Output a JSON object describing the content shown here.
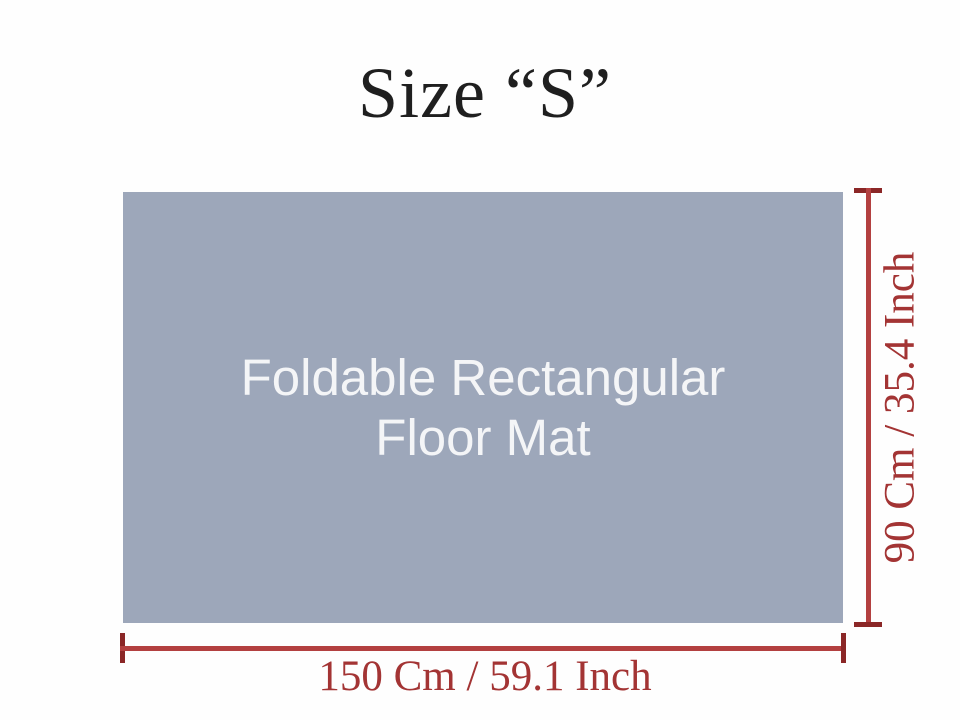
{
  "title": "Size “S”",
  "mat": {
    "label_line1": "Foldable Rectangular",
    "label_line2": "Floor Mat"
  },
  "dimensions": {
    "height_label": "90 Cm / 35.4 Inch",
    "width_label": "150 Cm / 59.1 Inch"
  },
  "colors": {
    "--page-bg": "#fefefe",
    "--title-color": "#1f1f1f",
    "--mat-bg": "#9da7ba",
    "--mat-text": "#f4f5f7",
    "--line-color": "#b34040",
    "--cap-color": "#8b2727",
    "--dim-text": "#a33434"
  }
}
